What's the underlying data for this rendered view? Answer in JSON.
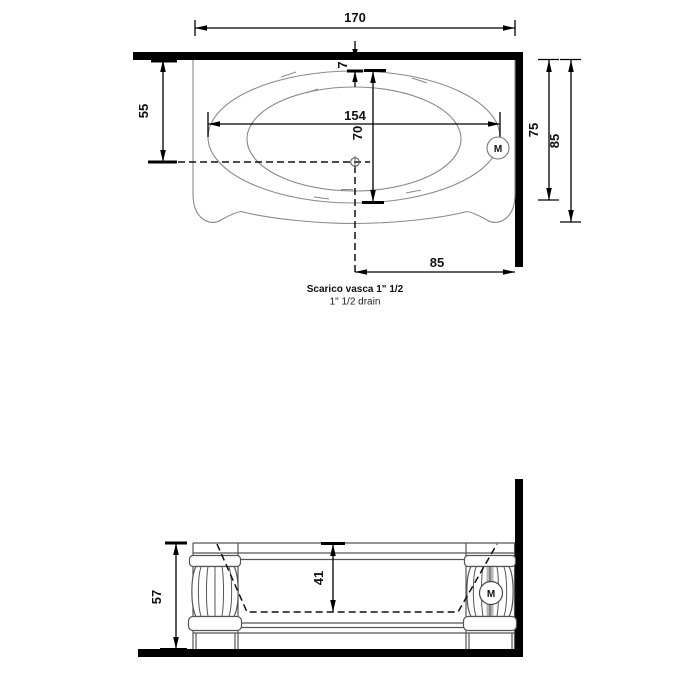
{
  "top_view": {
    "overall_width": "170",
    "wall_to_drain_axis": "55",
    "rim_offset": "7",
    "basin_length": "154",
    "basin_width": "70",
    "depth_inner": "75",
    "depth_outer": "85",
    "drain_to_wall": "85",
    "motor": "M",
    "caption_bold": "Scarico vasca 1\" 1/2",
    "caption_sub": "1\" 1/2  drain"
  },
  "side_view": {
    "overall_height": "57",
    "basin_depth": "41",
    "motor": "M"
  }
}
